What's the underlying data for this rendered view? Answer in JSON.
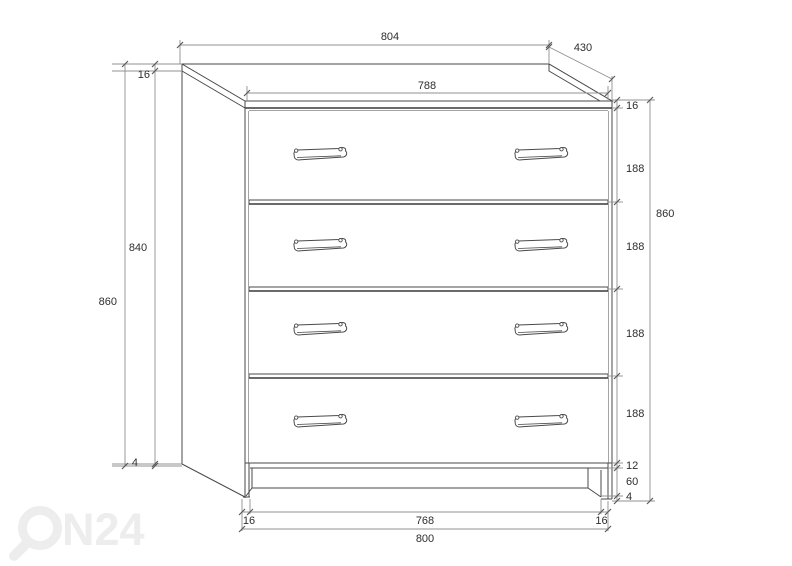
{
  "drawing": {
    "dims": {
      "top_width": "804",
      "depth": "430",
      "inner_width": "788",
      "left_top_thickness": "16",
      "left_body_height": "840",
      "left_overall_height": "860",
      "left_bottom": "4",
      "right_top_thickness": "16",
      "drawer_1": "188",
      "drawer_2": "188",
      "drawer_3": "188",
      "drawer_4": "188",
      "right_overall_height": "860",
      "bottom_rail": "12",
      "plinth": "60",
      "floor_gap": "4",
      "bottom_left_side": "16",
      "bottom_inner": "768",
      "bottom_right_side": "16",
      "bottom_overall": "800"
    },
    "colors": {
      "outline": "#4a4a4a",
      "bold_outline": "#383838",
      "dimension_line": "#909090",
      "tick": "#5a5a5a",
      "text": "#2e2e2e",
      "watermark": "#ededed"
    }
  },
  "watermark": {
    "label": "ON24",
    "text_after_logo": "N24"
  }
}
